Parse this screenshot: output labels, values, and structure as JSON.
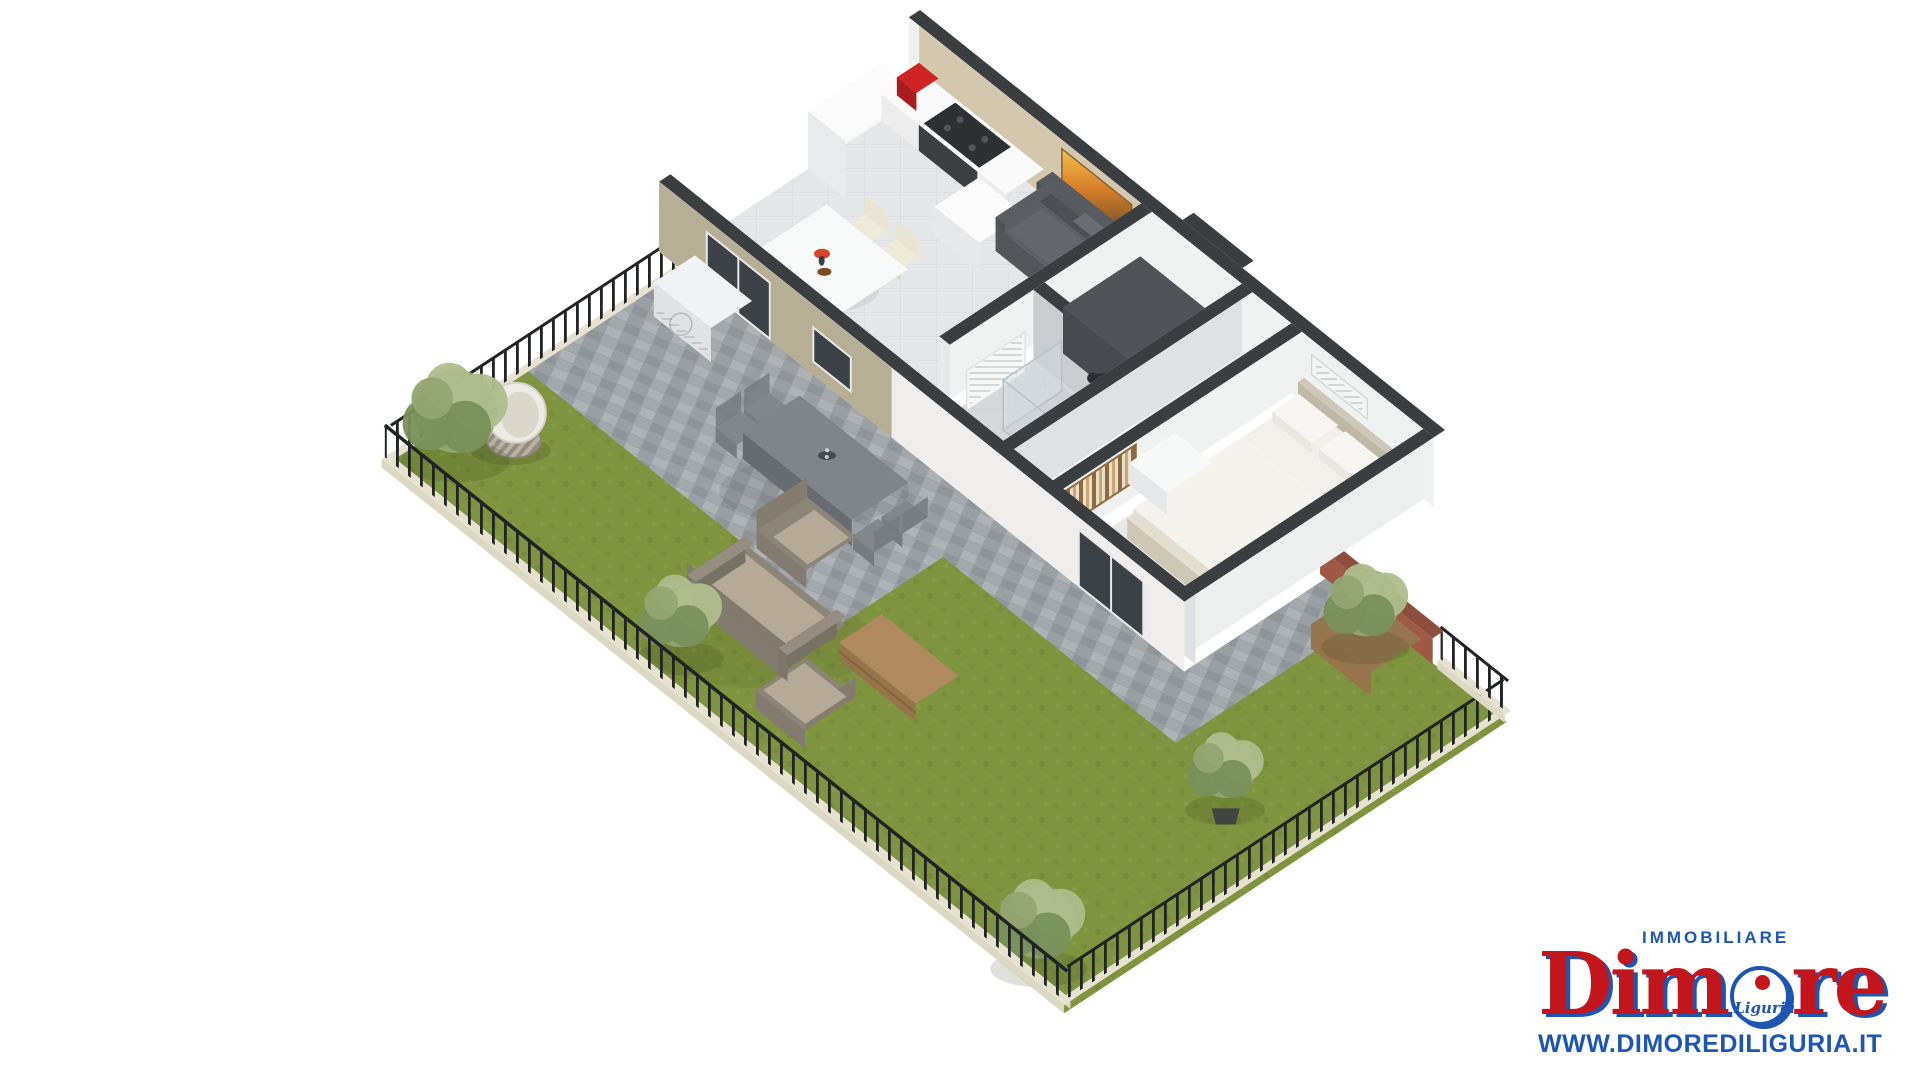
{
  "branding": {
    "tagline": "IMMOBILIARE",
    "brand_prefix": "Dim",
    "brand_suffix": "re",
    "badge": "Liguria",
    "website": "WWW.DIMOREDILIGURIA.IT",
    "brand_red": "#c3151c",
    "brand_blue": "#1d56b2"
  },
  "palette": {
    "wall_cap": "#3b3e41",
    "wall_beige": "#b7af95",
    "wall_beige_inner": "#d3c7ae",
    "wall_white": "#f0f1f1",
    "wall_shade": "#dfe1e3",
    "floor_light": "#e4e6e7",
    "floor_bath": "#d6d9db",
    "floor_bed": "#eae8e4",
    "grass": "#7f943e",
    "grass_dark": "#6f8334",
    "grass_light": "#8ba04a",
    "paver": "#9ba2a6",
    "paver_dark": "#8f969b",
    "paver_light": "#adb3b7",
    "curb": "#ddd8c4",
    "fence": "#212325",
    "wood": "#b08a5e",
    "wood_dark": "#96744c",
    "taupe": "#8d8478",
    "taupe_dark": "#7d766b",
    "cushion": "#b5a997",
    "sofa_indoor": "#5c6065",
    "white_obj": "#f4f5f5",
    "red_appliance": "#cf2424",
    "cooktop": "#2e3134",
    "tree": "#93a571",
    "tree_dark": "#78905b",
    "tree_light": "#aebd8c",
    "trunk": "#6f5f49",
    "brick": "#a05a43",
    "glass": "#3a4147",
    "bed": "#e6dfd0",
    "bedding": "#f2f0ea",
    "metal": "#81878b",
    "metal_dark": "#6e7478"
  },
  "scene": {
    "type": "3d-floor-plan-render",
    "rooms": [
      "living-room-kitchen",
      "entrance-hall",
      "bathroom",
      "hallway",
      "bedroom"
    ],
    "garden_objects": [
      "lawn",
      "paved-patio",
      "metal-railing-fence",
      "outdoor-dining-set",
      "hanging-egg-chair",
      "outdoor-sofa",
      "outdoor-armchairs",
      "wooden-coffee-table",
      "air-conditioner-condenser",
      "trees",
      "wooden-planter",
      "brick-garden-wall"
    ],
    "furniture": [
      "kitchen-counter",
      "cooktop",
      "red-coffee-machine",
      "tall-cabinet",
      "dining-table-with-chairs",
      "gray-sofa",
      "sunset-painting",
      "towel-radiator",
      "shower",
      "toilet",
      "hall-wardrobe",
      "double-bed",
      "bedside-table",
      "striped-wall-art",
      "wall-ac-unit"
    ]
  }
}
